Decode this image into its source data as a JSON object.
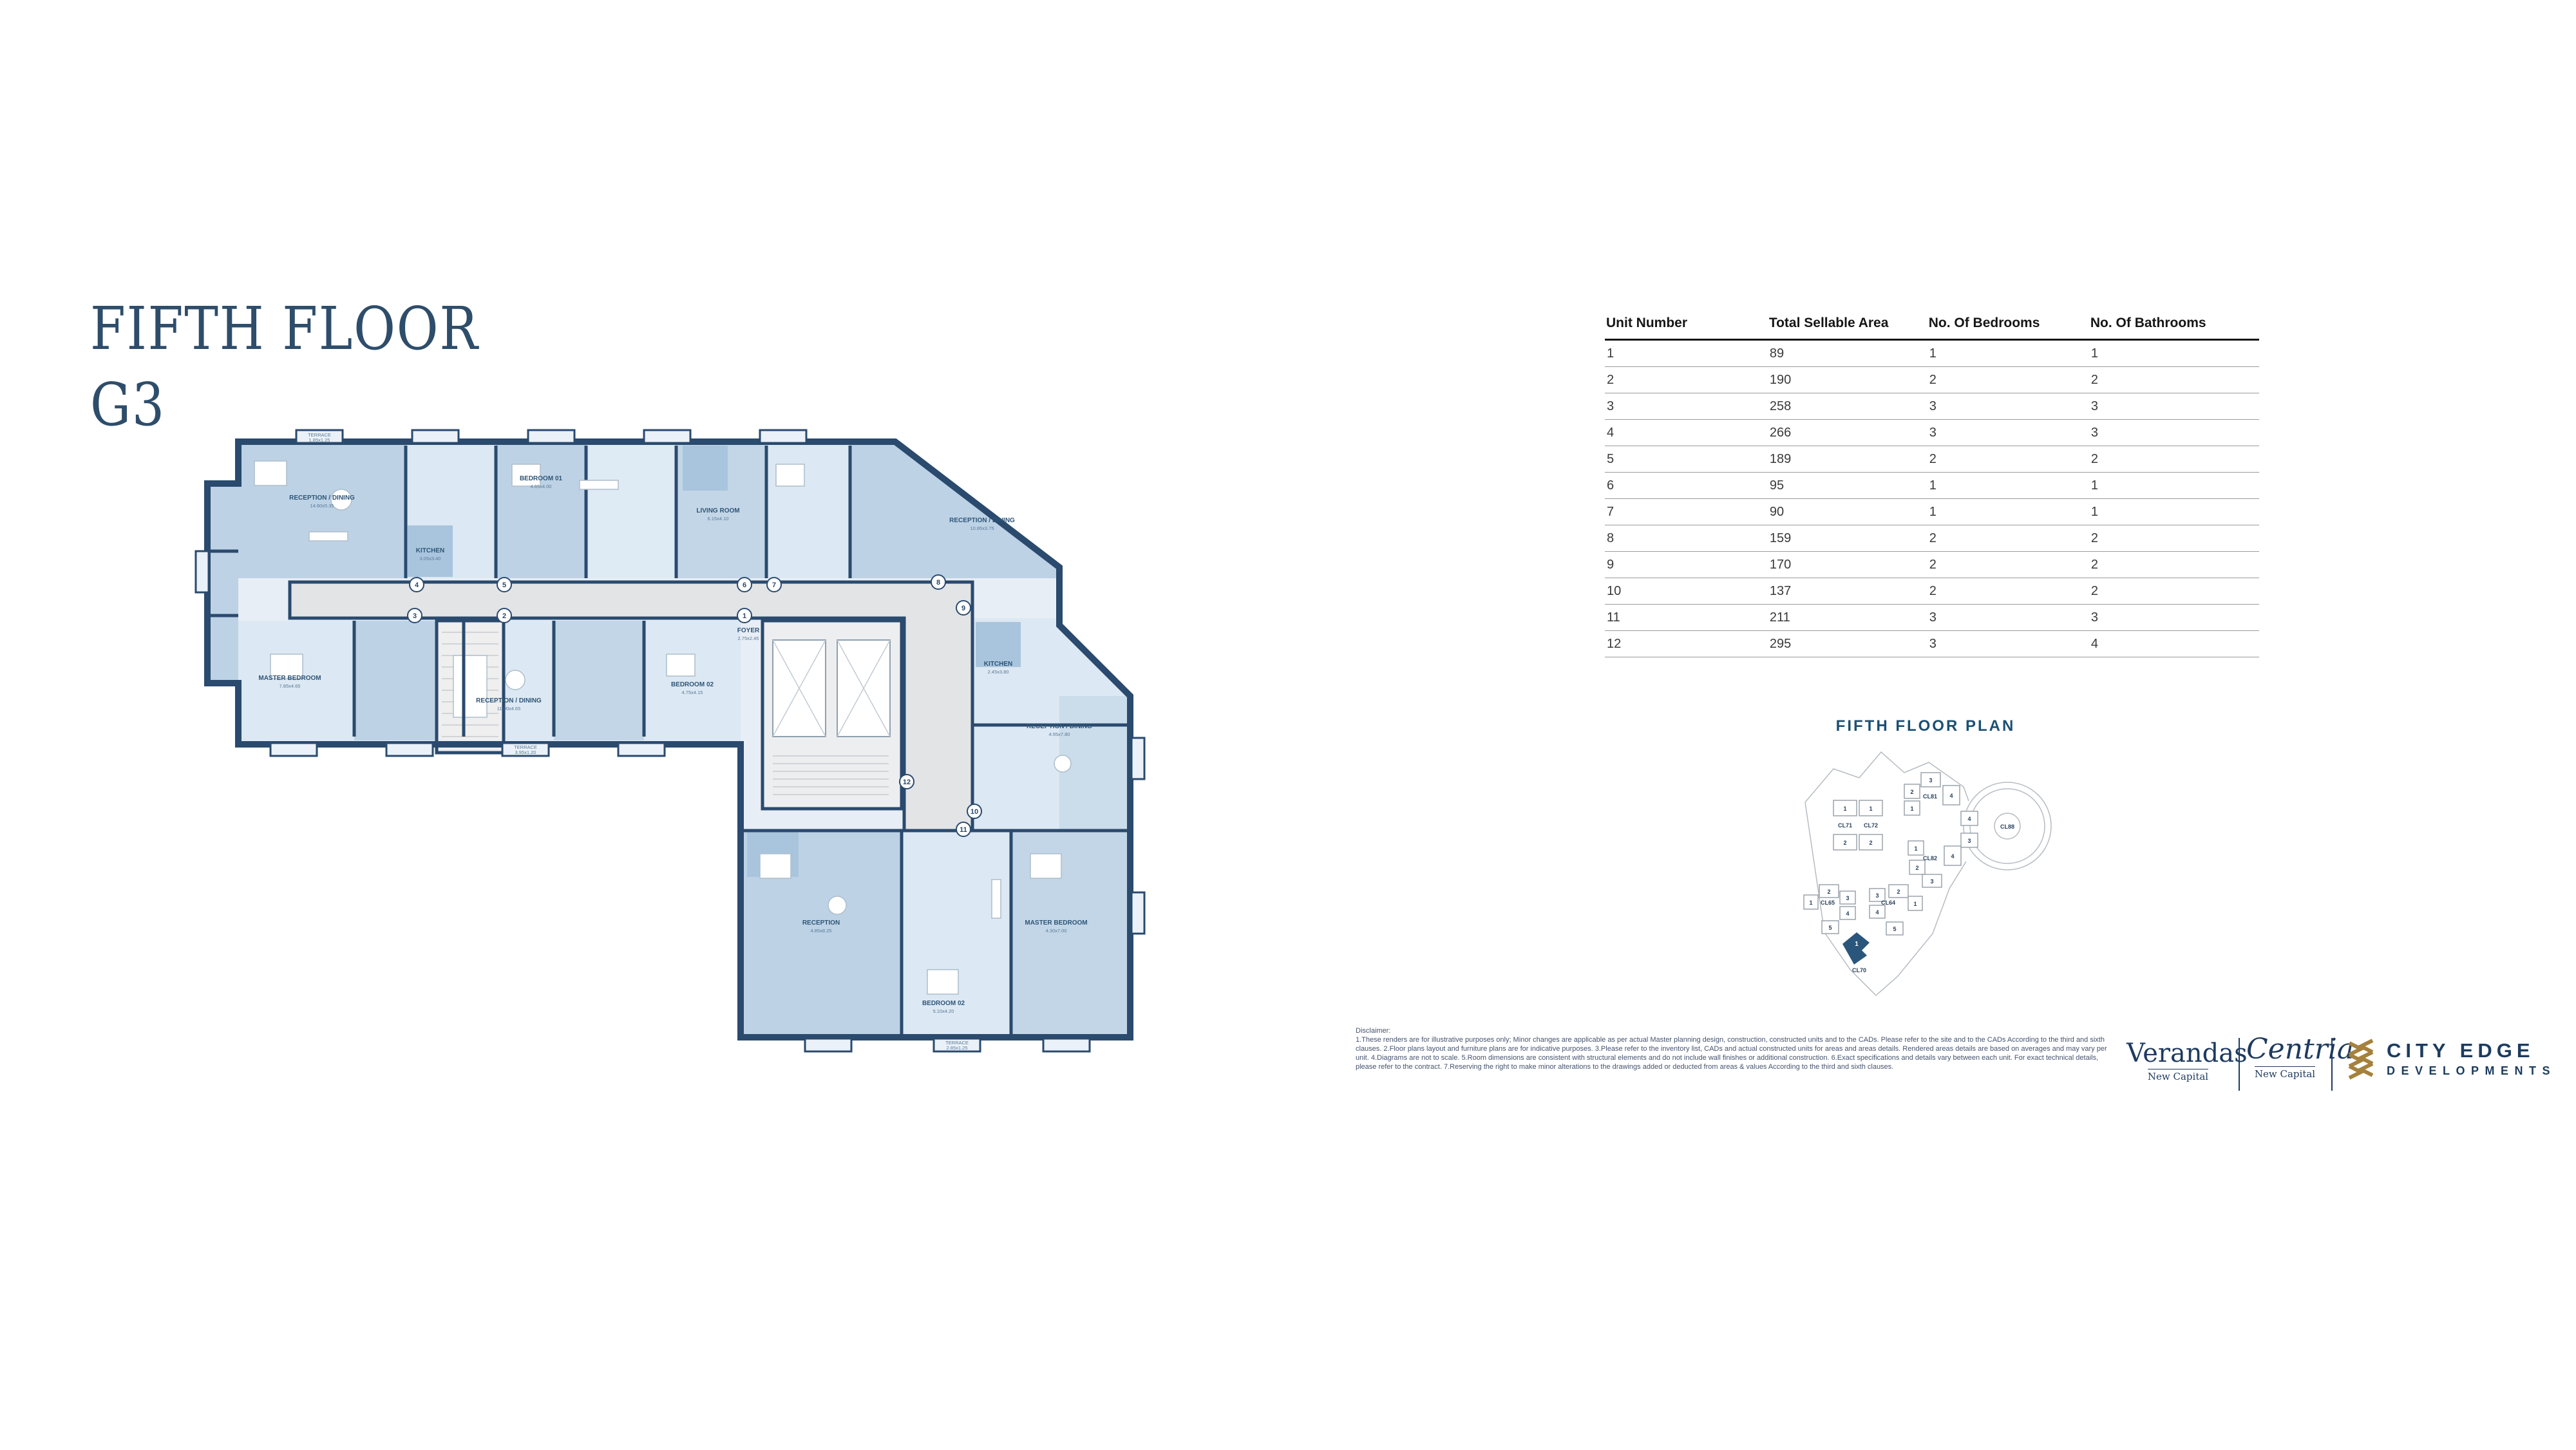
{
  "page": {
    "title_line1": "FIFTH FLOOR",
    "title_line2": "G3"
  },
  "table": {
    "headers": [
      "Unit Number",
      "Total Sellable Area",
      "No. Of Bedrooms",
      "No. Of Bathrooms"
    ],
    "rows": [
      [
        "1",
        "89",
        "1",
        "1"
      ],
      [
        "2",
        "190",
        "2",
        "2"
      ],
      [
        "3",
        "258",
        "3",
        "3"
      ],
      [
        "4",
        "266",
        "3",
        "3"
      ],
      [
        "5",
        "189",
        "2",
        "2"
      ],
      [
        "6",
        "95",
        "1",
        "1"
      ],
      [
        "7",
        "90",
        "1",
        "1"
      ],
      [
        "8",
        "159",
        "2",
        "2"
      ],
      [
        "9",
        "170",
        "2",
        "2"
      ],
      [
        "10",
        "137",
        "2",
        "2"
      ],
      [
        "11",
        "211",
        "3",
        "3"
      ],
      [
        "12",
        "295",
        "3",
        "4"
      ]
    ]
  },
  "plan": {
    "unit_markers": [
      "4",
      "3",
      "5",
      "2",
      "6",
      "7",
      "1",
      "8",
      "9",
      "12",
      "10",
      "11"
    ],
    "labels": [
      {
        "name": "RECEPTION / DINING",
        "dims": "14.60x5.35"
      },
      {
        "name": "BEDROOM 01",
        "dims": "4.65x4.00"
      },
      {
        "name": "LIVING ROOM",
        "dims": "6.15x4.10"
      },
      {
        "name": "RECEPTION / DINING",
        "dims": "10.85x3.75"
      },
      {
        "name": "KITCHEN",
        "dims": "3.05x3.40"
      },
      {
        "name": "MASTER BEDROOM",
        "dims": "7.85x4.65"
      },
      {
        "name": "RECEPTION / DINING",
        "dims": "11.00x4.65"
      },
      {
        "name": "BEDROOM 02",
        "dims": "4.75x4.15"
      },
      {
        "name": "FOYER",
        "dims": "2.75x2.45"
      },
      {
        "name": "RECEPTION",
        "dims": "4.85x8.25"
      },
      {
        "name": "MASTER BEDROOM",
        "dims": "4.30x7.00"
      },
      {
        "name": "BEDROOM 02",
        "dims": "5.10x4.20"
      },
      {
        "name": "RECEPTION / DINING",
        "dims": "4.95x7.80"
      },
      {
        "name": "KITCHEN",
        "dims": "2.45x3.80"
      },
      {
        "name": "TERRACE",
        "dims": "1.85x1.25"
      },
      {
        "name": "TERRACE",
        "dims": "3.95x1.20"
      },
      {
        "name": "TERRACE",
        "dims": "2.85x1.25"
      }
    ]
  },
  "key_plan": {
    "title": "FIFTH FLOOR PLAN",
    "clusters": [
      "CL71",
      "CL72",
      "CL81",
      "CL82",
      "CL88",
      "CL65",
      "CL64",
      "CL70"
    ],
    "badges": [
      "1",
      "2",
      "1",
      "2",
      "3",
      "2",
      "1",
      "4",
      "1",
      "4",
      "2",
      "3",
      "4",
      "3",
      "2",
      "1",
      "3",
      "4",
      "5",
      "3",
      "2",
      "1",
      "4",
      "5",
      "1"
    ]
  },
  "disclaimer": {
    "heading": "Disclaimer:",
    "body": "1.These renders are for illustrative purposes only; Minor changes are applicable as per actual Master planning design, construction, constructed units and to the CADs. Please refer to the site and to the CADs According to the third and sixth clauses. 2.Floor plans layout and furniture plans are for indicative purposes. 3.Please refer to the inventory list, CADs and actual constructed units for areas and areas details. Rendered areas details are based on averages and may vary per unit. 4.Diagrams are not to scale. 5.Room dimensions are consistent with structural elements and do not include wall finishes or additional construction. 6.Exact specifications and details vary between each unit. For exact technical details, please refer to the contract. 7.Reserving the right to make minor alterations to the drawings added or deducted from areas & values According to the third and sixth clauses."
  },
  "logos": {
    "verandas": {
      "name": "Verandas",
      "subtitle": "New Capital"
    },
    "centria": {
      "name": "Centria",
      "subtitle": "New Capital"
    },
    "city_edge": {
      "line1": "CITY EDGE",
      "line2": "DEVELOPMENTS"
    }
  },
  "colors": {
    "accent_navy": "#2E4D6B",
    "wall_navy": "#2A4A6E",
    "room_blue": "#BDD2E5",
    "room_light": "#DCE8F3",
    "kitchen_blue": "#A9C5DD",
    "corridor_gray": "#E3E4E6",
    "gold": "#A5813D",
    "logo_navy": "#1C3C5E"
  }
}
